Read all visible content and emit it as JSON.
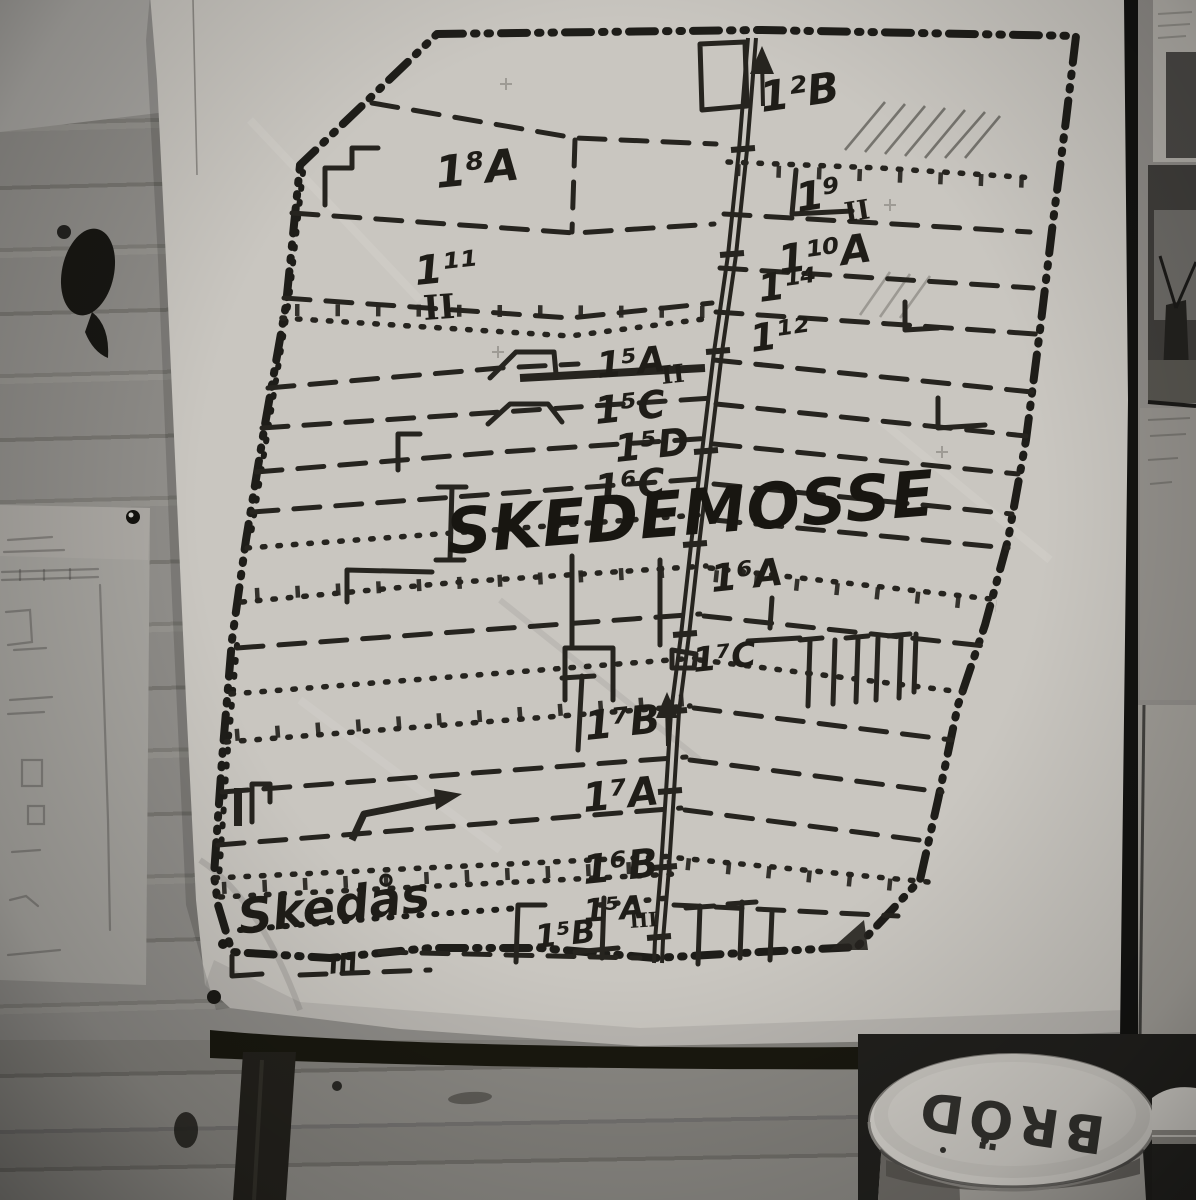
{
  "photo": {
    "wall_map": {
      "title": "SKEDEMOSSE",
      "area_labels": {
        "b2": "1²B",
        "a8": "1⁸A",
        "s9": "1⁹",
        "s9_sub": "II",
        "a10": "1¹⁰A",
        "s11": "1¹¹",
        "s11_sub": "II",
        "s14": "1¹⁴",
        "s12": "1¹²",
        "a5_upper": "1⁵A",
        "a5_upper_sub": "II",
        "c5": "1⁵C",
        "d5": "1⁵D",
        "c6": "1⁶C",
        "a6": "1⁶A",
        "c7": "1⁷C",
        "b7": "1⁷B",
        "a7": "1⁷A",
        "b6": "1⁶B",
        "a5_lower": "1⁵A",
        "a5_lower_sub": "III",
        "b5": "1⁵B"
      },
      "place_name": "Skedås",
      "place_mark": "III"
    },
    "bread_tin": {
      "label": "BRÖD"
    }
  }
}
